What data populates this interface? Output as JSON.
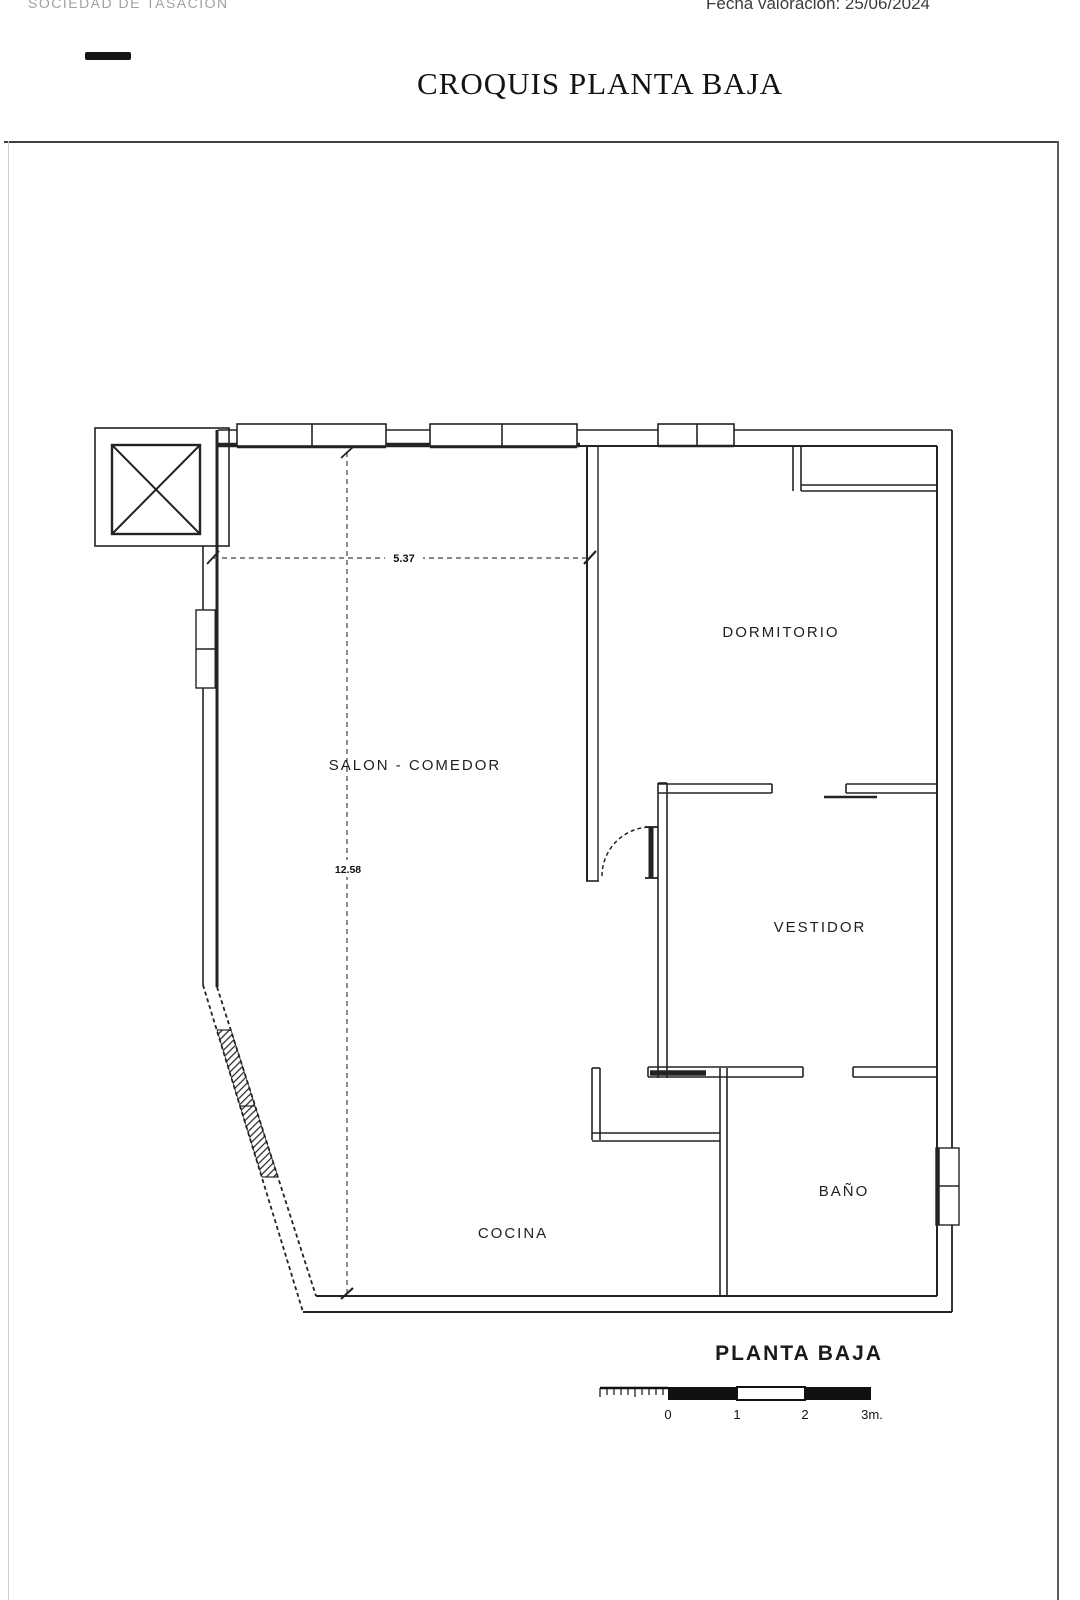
{
  "colors": {
    "ink": "#232323",
    "paper": "#ffffff",
    "muted_header": "#a0a0a0"
  },
  "header": {
    "company": "SOCIEDAD DE TASACIÓN",
    "valuation_date": "Fecha valoración: 25/06/2024",
    "title": "CROQUIS PLANTA BAJA"
  },
  "plan": {
    "rooms": [
      {
        "id": "salon-comedor",
        "label": "SALON - COMEDOR"
      },
      {
        "id": "dormitorio",
        "label": "DORMITORIO"
      },
      {
        "id": "vestidor",
        "label": "VESTIDOR"
      },
      {
        "id": "bano",
        "label": "BAÑO"
      },
      {
        "id": "cocina",
        "label": "COCINA"
      }
    ],
    "dimensions": [
      {
        "id": "width",
        "value": "5.37"
      },
      {
        "id": "height",
        "value": "12.58"
      }
    ],
    "caption": "PLANTA BAJA",
    "scale_bar": {
      "tick_labels": [
        "0",
        "1",
        "2",
        "3m."
      ]
    }
  }
}
